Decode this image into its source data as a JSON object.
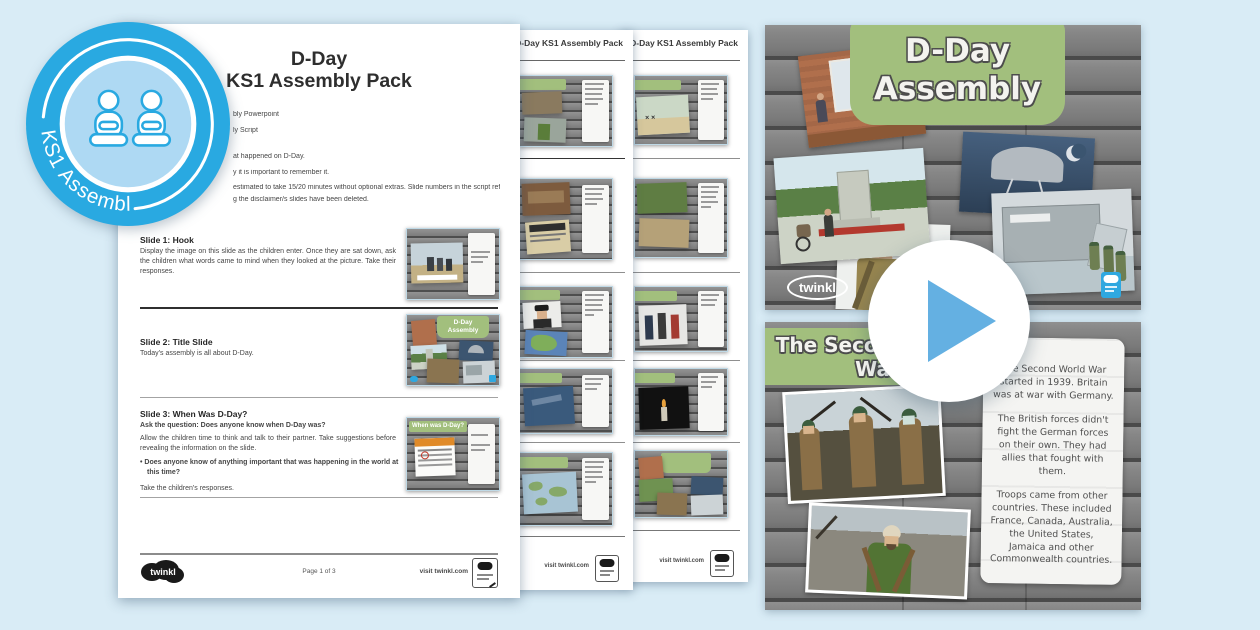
{
  "colors": {
    "twinkl_blue": "#29a9e1",
    "slide_green": "#a2bf7d",
    "play_triangle": "#64b0e2",
    "background": "#d9ecf6"
  },
  "badge": {
    "label": "KS1 Assembly",
    "icon": "seated-children-icon"
  },
  "doc": {
    "title1": "D-Day",
    "title2": "KS1 Assembly Pack",
    "fragments": [
      "bly Powerpoint",
      "ly Script",
      "at happened on D-Day.",
      "y it is important to remember it.",
      "estimated to take 15/20 minutes without optional extras. Slide numbers in the script refer",
      "g the disclaimer/s slides have been deleted."
    ],
    "s1_heading": "Slide 1: Hook",
    "s1_body": "Display the image on this slide as the children enter. Once they are sat down, ask the children what words came to mind when they looked at the picture. Take their responses.",
    "s2_heading": "Slide 2: Title Slide",
    "s2_body": "Today's assembly is all about D-Day.",
    "s3_heading": "Slide 3: When Was D-Day?",
    "s3_question": "Ask the question: Does anyone know when D-Day was?",
    "s3_body": "Allow the children time to think and talk to their partner. Take suggestions before revealing the information on the slide.",
    "s3_bullet": "• Does anyone know of anything important that was happening in the world at this time?",
    "s3_closing": "Take the children's responses.",
    "thumb3_banner": "When was D-Day?",
    "footer_brand": "twinkl",
    "footer_page": "Page 1 of 3",
    "footer_site": "visit twinkl.com"
  },
  "stack": {
    "header": "D-Day KS1 Assembly Pack",
    "site": "visit twinkl.com"
  },
  "title_slide": {
    "line1": "D-Day",
    "line2": "Assembly",
    "brand": "twinkl"
  },
  "ww2": {
    "title_line1": "The Second World",
    "title_line2": "War",
    "p1": "The Second World War started in 1939. Britain was at war with Germany.",
    "p2": "The British forces didn't fight the German forces on their own. They had allies that fought with them.",
    "p3": "Troops came from other countries. These included France, Canada, Australia, the United States, Jamaica and other Commonwealth countries."
  }
}
